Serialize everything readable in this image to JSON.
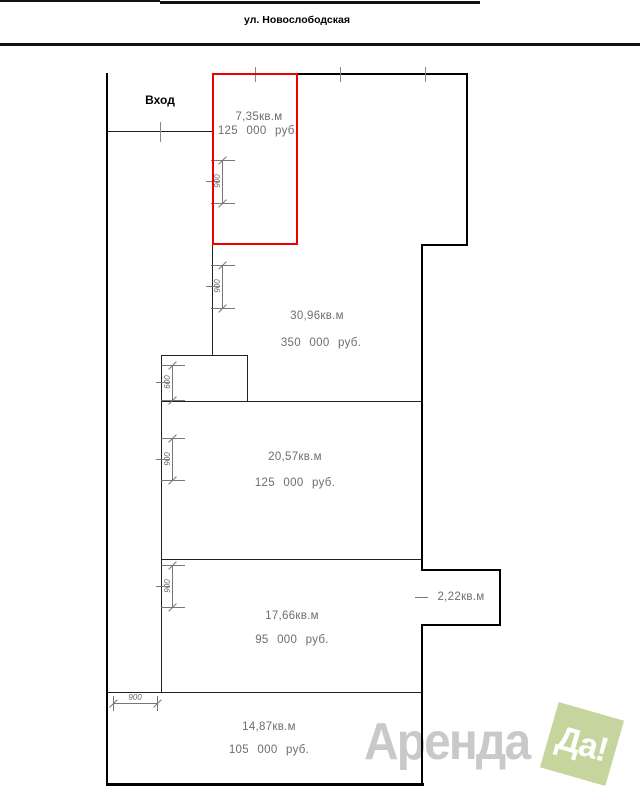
{
  "street": {
    "name": "ул. Новослободская"
  },
  "entrance": {
    "label": "Вход"
  },
  "units": [
    {
      "id": "unit-7-35",
      "area": "7,35кв.м",
      "price": "125 000 руб.",
      "highlighted": true
    },
    {
      "id": "unit-30-96",
      "area": "30,96кв.м",
      "price": "350 000 руб.",
      "highlighted": false
    },
    {
      "id": "unit-20-57",
      "area": "20,57кв.м",
      "price": "125 000 руб.",
      "highlighted": false
    },
    {
      "id": "unit-2-22",
      "area": "2,22кв.м",
      "price": "",
      "highlighted": false
    },
    {
      "id": "unit-17-66",
      "area": "17,66кв.м",
      "price": "95 000 руб.",
      "highlighted": false
    },
    {
      "id": "unit-14-87",
      "area": "14,87кв.м",
      "price": "105 000 руб.",
      "highlighted": false
    }
  ],
  "dims": {
    "d1": "900",
    "d2": "900",
    "d3": "600",
    "d4": "900",
    "d5": "900",
    "d6": "900"
  },
  "watermark": {
    "brand": "Аренда",
    "badge": "Да!"
  },
  "colors": {
    "highlight": "#ee0000",
    "wall": "#000000",
    "dimension": "#777777",
    "unit_text": "#6e6e6e",
    "watermark_text": "#c9c9c9",
    "badge_bg": "#c6d59d",
    "badge_text": "#ffffff"
  }
}
